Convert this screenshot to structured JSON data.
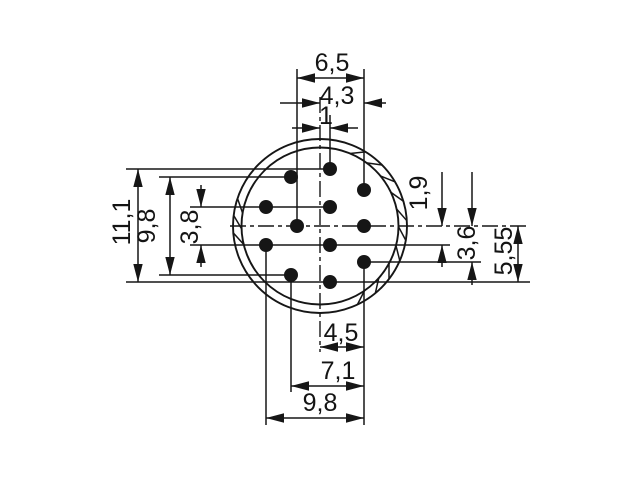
{
  "drawing": {
    "background": "#ffffff",
    "ink": "#161616",
    "center": {
      "x": 320,
      "y": 226
    },
    "ring": {
      "r_outer": 87,
      "r_inner": 78.5
    },
    "ring_ticks": {
      "right_run_deg": [
        63,
        49,
        35,
        21,
        8,
        -5,
        -19,
        -33,
        -46,
        -60
      ],
      "left_run_deg": [
        166,
        177.5,
        189
      ],
      "slant_deg": 4.5
    },
    "pin_radius": 7,
    "pins": [
      {
        "x": 330,
        "y": 169
      },
      {
        "x": 291,
        "y": 177
      },
      {
        "x": 364,
        "y": 190
      },
      {
        "x": 266,
        "y": 207
      },
      {
        "x": 330,
        "y": 207
      },
      {
        "x": 297,
        "y": 226
      },
      {
        "x": 364,
        "y": 226
      },
      {
        "x": 266,
        "y": 245
      },
      {
        "x": 330,
        "y": 245
      },
      {
        "x": 291,
        "y": 275
      },
      {
        "x": 364,
        "y": 262
      },
      {
        "x": 330,
        "y": 282
      }
    ],
    "centerlines": [
      {
        "x1": 230,
        "y1": 226,
        "x2": 530,
        "y2": 226
      },
      {
        "x1": 320,
        "y1": 97,
        "x2": 320,
        "y2": 352
      }
    ],
    "extension_lines": [
      {
        "x1": 126,
        "y1": 169,
        "x2": 330,
        "y2": 169
      },
      {
        "x1": 159,
        "y1": 177,
        "x2": 291,
        "y2": 177
      },
      {
        "x1": 190,
        "y1": 207,
        "x2": 330,
        "y2": 207
      },
      {
        "x1": 190,
        "y1": 245,
        "x2": 450,
        "y2": 245
      },
      {
        "x1": 364,
        "y1": 262,
        "x2": 481,
        "y2": 262
      },
      {
        "x1": 159,
        "y1": 275,
        "x2": 291,
        "y2": 275
      },
      {
        "x1": 126,
        "y1": 282,
        "x2": 530,
        "y2": 282
      },
      {
        "x1": 297,
        "y1": 69,
        "x2": 297,
        "y2": 226
      },
      {
        "x1": 330,
        "y1": 115,
        "x2": 330,
        "y2": 169
      },
      {
        "x1": 364,
        "y1": 69,
        "x2": 364,
        "y2": 190
      },
      {
        "x1": 364,
        "y1": 262,
        "x2": 364,
        "y2": 425
      },
      {
        "x1": 291,
        "y1": 275,
        "x2": 291,
        "y2": 392
      },
      {
        "x1": 266,
        "y1": 245,
        "x2": 266,
        "y2": 425
      }
    ],
    "dimensions": [
      {
        "label": "6,5",
        "style": "inside",
        "orient": "h",
        "pos": 78,
        "a": 297,
        "b": 364
      },
      {
        "label": "4,3",
        "style": "outside",
        "orient": "h",
        "pos": 103,
        "a": 320,
        "b": 364,
        "stub_a": 40,
        "stub_b": 22
      },
      {
        "label": "1",
        "style": "outside",
        "orient": "h",
        "pos": 128,
        "a": 320,
        "b": 330,
        "stub_a": 28,
        "stub_b": 28
      },
      {
        "label": "11,1",
        "style": "inside",
        "orient": "v",
        "pos": 138,
        "a": 169,
        "b": 282
      },
      {
        "label": "9,8",
        "style": "inside",
        "orient": "v",
        "pos": 170,
        "a": 177,
        "b": 275
      },
      {
        "label": "3,8",
        "style": "outside",
        "orient": "v",
        "pos": 201,
        "a": 207,
        "b": 245,
        "stub_a": 22,
        "stub_b": 22
      },
      {
        "label": "1,9",
        "style": "outside",
        "orient": "v",
        "pos": 442,
        "a": 226,
        "b": 245,
        "stub_a": 54,
        "stub_b": 22
      },
      {
        "label": "3,6",
        "style": "outside",
        "orient": "v",
        "pos": 472,
        "a": 226,
        "b": 262,
        "stub_a": 54,
        "stub_b": 23
      },
      {
        "label": "5,55",
        "style": "inside",
        "orient": "v",
        "pos": 518,
        "a": 226,
        "b": 282
      },
      {
        "label": "4,5",
        "style": "inside",
        "orient": "h",
        "pos": 347,
        "a": 320,
        "b": 364
      },
      {
        "label": "7,1",
        "style": "inside",
        "orient": "h",
        "pos": 386,
        "a": 291,
        "b": 364
      },
      {
        "label": "9,8",
        "style": "inside",
        "orient": "h",
        "pos": 418,
        "a": 266,
        "b": 364
      }
    ]
  }
}
